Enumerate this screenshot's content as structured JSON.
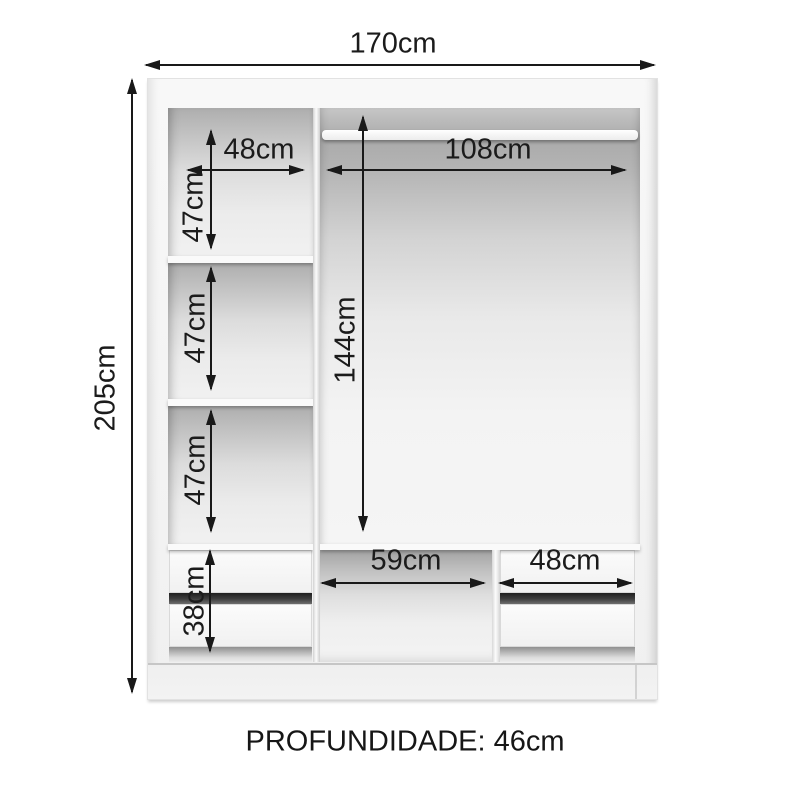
{
  "dimensions": {
    "overall_width": "170cm",
    "overall_height": "205cm",
    "depth_note": "PROFUNDIDADE: 46cm"
  },
  "left_column": {
    "shelf_width": "48cm",
    "compartments": [
      {
        "height": "47cm"
      },
      {
        "height": "47cm"
      },
      {
        "height": "47cm"
      }
    ],
    "drawer_stack_height": "38cm"
  },
  "right_section": {
    "hanging_width": "108cm",
    "hanging_height": "144cm",
    "niche_width": "59cm",
    "drawer_unit_width": "48cm"
  },
  "colors": {
    "dimension_line": "#191919",
    "background": "#ffffff",
    "furniture_body": "#f2f2f2",
    "interior_shadow": "#aaaaaa"
  }
}
